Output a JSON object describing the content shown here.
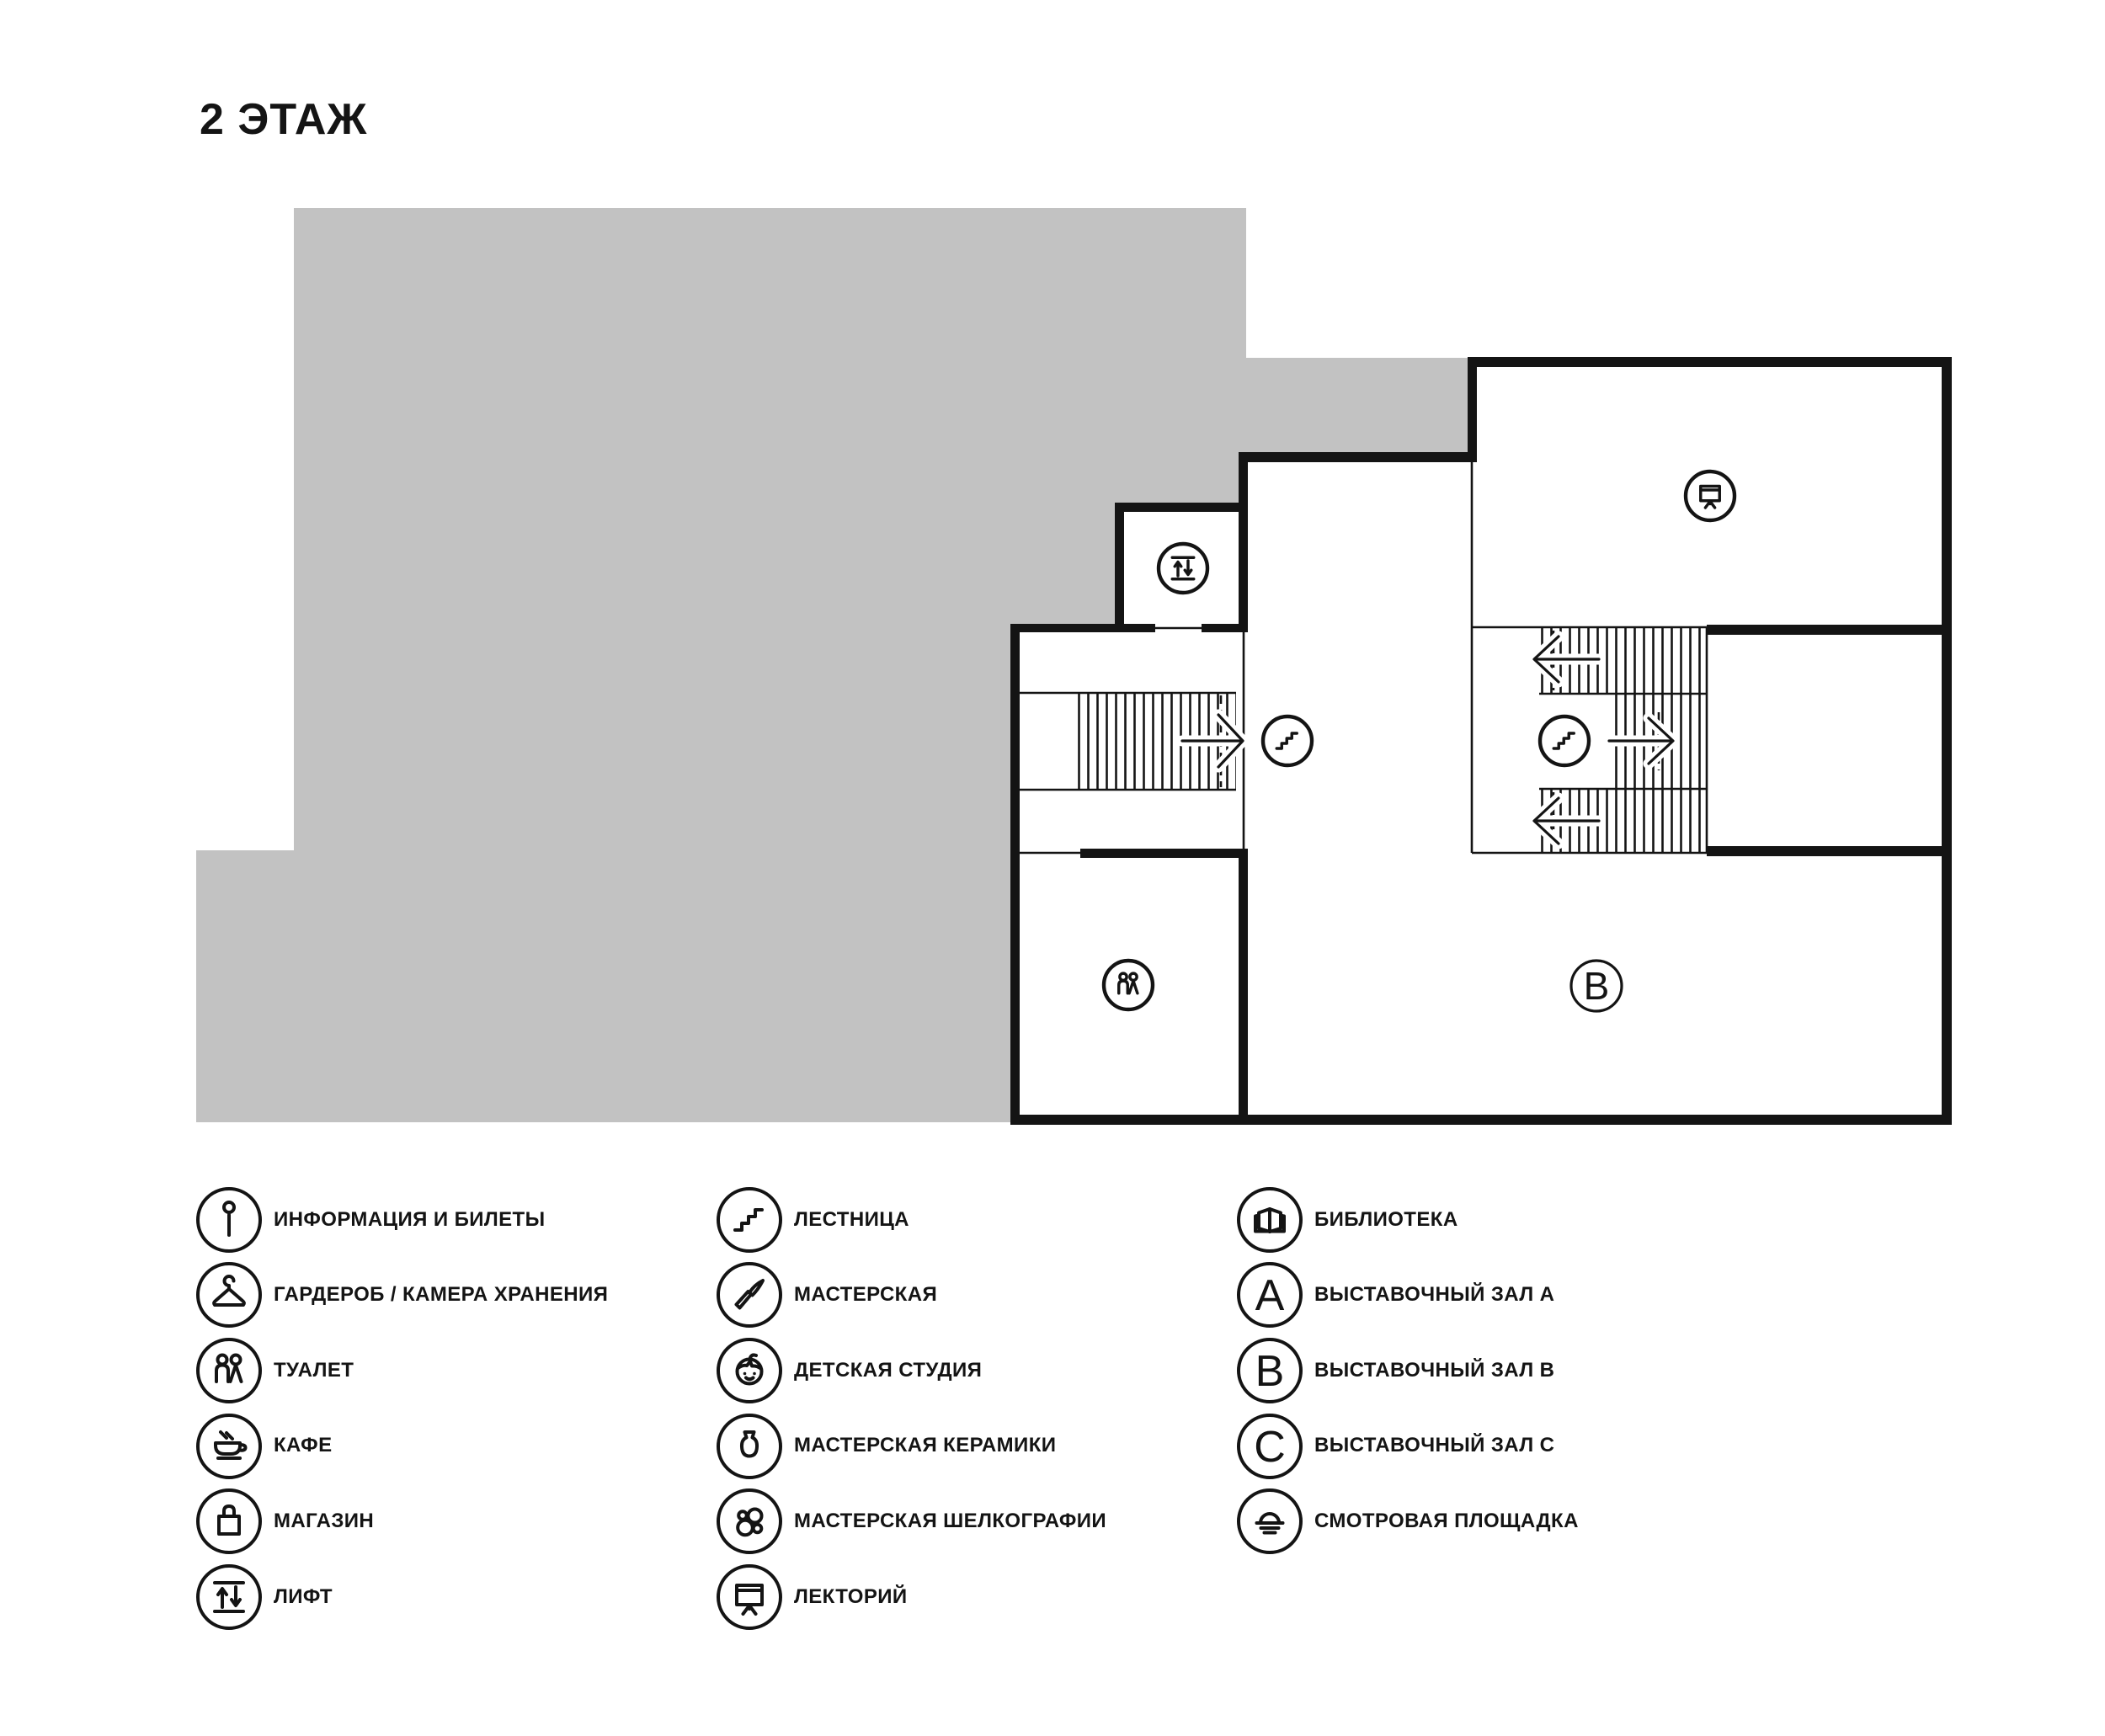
{
  "page": {
    "title": "2 ЭТАЖ"
  },
  "plan": {
    "floor_area_color": "#c2c2c2",
    "line_color": "#141414",
    "hall_b_label": "B",
    "plan_icons": [
      "elevator",
      "stairs",
      "stairs",
      "lecture-screen",
      "toilet"
    ]
  },
  "legend": {
    "columns": [
      {
        "items": [
          {
            "icon": "info",
            "label": "ИНФОРМАЦИЯ И БИЛЕТЫ"
          },
          {
            "icon": "hanger",
            "label": "ГАРДЕРОБ / КАМЕРА ХРАНЕНИЯ"
          },
          {
            "icon": "toilet",
            "label": "ТУАЛЕТ"
          },
          {
            "icon": "cafe",
            "label": "КАФЕ"
          },
          {
            "icon": "bag",
            "label": "МАГАЗИН"
          },
          {
            "icon": "lift",
            "label": "ЛИФТ"
          }
        ]
      },
      {
        "items": [
          {
            "icon": "stairs",
            "label": "ЛЕСТНИЦА"
          },
          {
            "icon": "brush",
            "label": "МАСТЕРСКАЯ"
          },
          {
            "icon": "child",
            "label": "ДЕТСКАЯ СТУДИЯ"
          },
          {
            "icon": "vase",
            "label": "МАСТЕРСКАЯ КЕРАМИКИ"
          },
          {
            "icon": "silkscreen",
            "label": "МАСТЕРСКАЯ ШЕЛКОГРАФИИ"
          },
          {
            "icon": "lecture-screen",
            "label": "ЛЕКТОРИЙ"
          }
        ]
      },
      {
        "items": [
          {
            "icon": "book",
            "label": "БИБЛИОТЕКА"
          },
          {
            "icon": "hall-a-marker",
            "letter": "A",
            "label": "ВЫСТАВОЧНЫЙ ЗАЛ A"
          },
          {
            "icon": "hall-b-marker",
            "letter": "B",
            "label": "ВЫСТАВОЧНЫЙ ЗАЛ B"
          },
          {
            "icon": "hall-c-marker",
            "letter": "C",
            "label": "ВЫСТАВОЧНЫЙ ЗАЛ C"
          },
          {
            "icon": "viewpoint",
            "label": "СМОТРОВАЯ ПЛОЩАДКА"
          }
        ]
      }
    ]
  }
}
